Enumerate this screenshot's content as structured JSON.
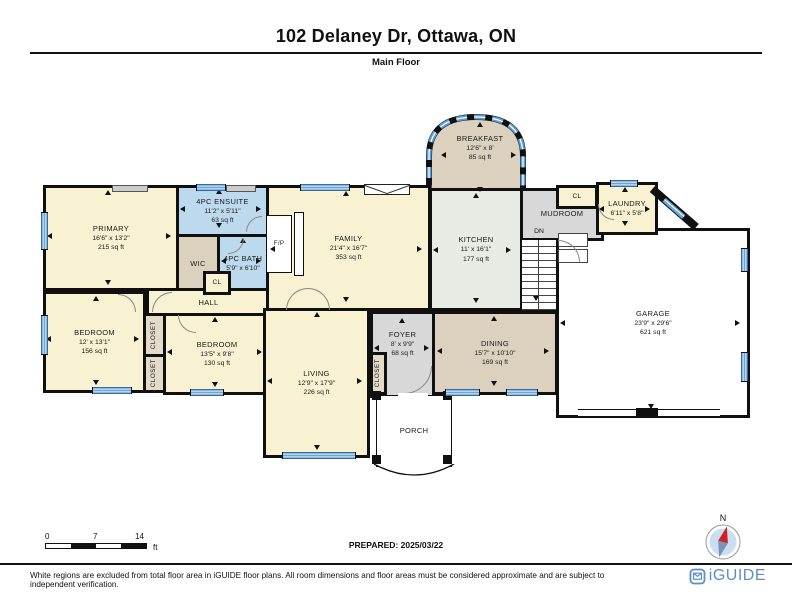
{
  "page": {
    "title": "102 Delaney Dr, Ottawa, ON",
    "subtitle": "Main Floor"
  },
  "rooms": {
    "primary": {
      "label": "PRIMARY",
      "dims": "16'6\" x 13'2\"",
      "area": "215 sq ft"
    },
    "ensuite": {
      "label": "4PC ENSUITE",
      "dims": "11'2\" x 5'11\"",
      "area": "63 sq ft"
    },
    "wic": {
      "label": "WIC"
    },
    "bath": {
      "label": "4PC BATH",
      "dims": "5'9\" x 6'10\""
    },
    "family": {
      "label": "FAMILY",
      "dims": "21'4\" x 16'7\"",
      "area": "353 sq ft"
    },
    "breakfast": {
      "label": "BREAKFAST",
      "dims": "12'6\" x 8'",
      "area": "85 sq ft"
    },
    "kitchen": {
      "label": "KITCHEN",
      "dims": "11' x 16'1\"",
      "area": "177 sq ft"
    },
    "mudroom": {
      "label": "MUDROOM"
    },
    "mudroom_closet": {
      "label": "CL"
    },
    "laundry": {
      "label": "LAUNDRY",
      "dims": "6'11\" x 5'8\""
    },
    "garage": {
      "label": "GARAGE",
      "dims": "23'9\" x 29'6\"",
      "area": "621 sq ft"
    },
    "dining": {
      "label": "DINING",
      "dims": "15'7\" x 10'10\"",
      "area": "169 sq ft"
    },
    "foyer": {
      "label": "FOYER",
      "dims": "8' x 9'9\"",
      "area": "68 sq ft"
    },
    "foyer_closet": {
      "label": "CLOSET"
    },
    "hall": {
      "label": "HALL"
    },
    "hall_closet": {
      "label": "CL"
    },
    "bedroom_left": {
      "label": "BEDROOM",
      "dims": "12' x 13'1\"",
      "area": "156 sq ft"
    },
    "bedroom_right": {
      "label": "BEDROOM",
      "dims": "13'5\" x 9'8\"",
      "area": "130 sq ft"
    },
    "closet_top": {
      "label": "CLOSET"
    },
    "closet_bottom": {
      "label": "CLOSET"
    },
    "living": {
      "label": "LIVING",
      "dims": "12'9\" x 17'9\"",
      "area": "226 sq ft"
    },
    "porch": {
      "label": "PORCH"
    },
    "fireplace": {
      "label": "F/P"
    },
    "stairs": {
      "label": "DN"
    }
  },
  "scale": {
    "zero": "0",
    "mid": "7",
    "max": "14",
    "unit": "ft"
  },
  "prepared_label": "PREPARED: 2025/03/22",
  "compass": {
    "north_label": "N"
  },
  "footer": {
    "disclaimer": "White regions are excluded from total floor area in iGUIDE floor plans. All room dimensions and floor areas must be considered approximate and are subject to independent verification.",
    "brand": "iGUIDE"
  },
  "colors": {
    "room_cream": "#f8f1d2",
    "room_blue": "#bdd9ee",
    "room_tan": "#dcd1bf",
    "room_gray": "#d8d8d8",
    "room_mint": "#e6ece4",
    "window_blue": "#5b9bd5",
    "brand_blue": "#5b8fc9",
    "compass_red": "#cc2222"
  }
}
